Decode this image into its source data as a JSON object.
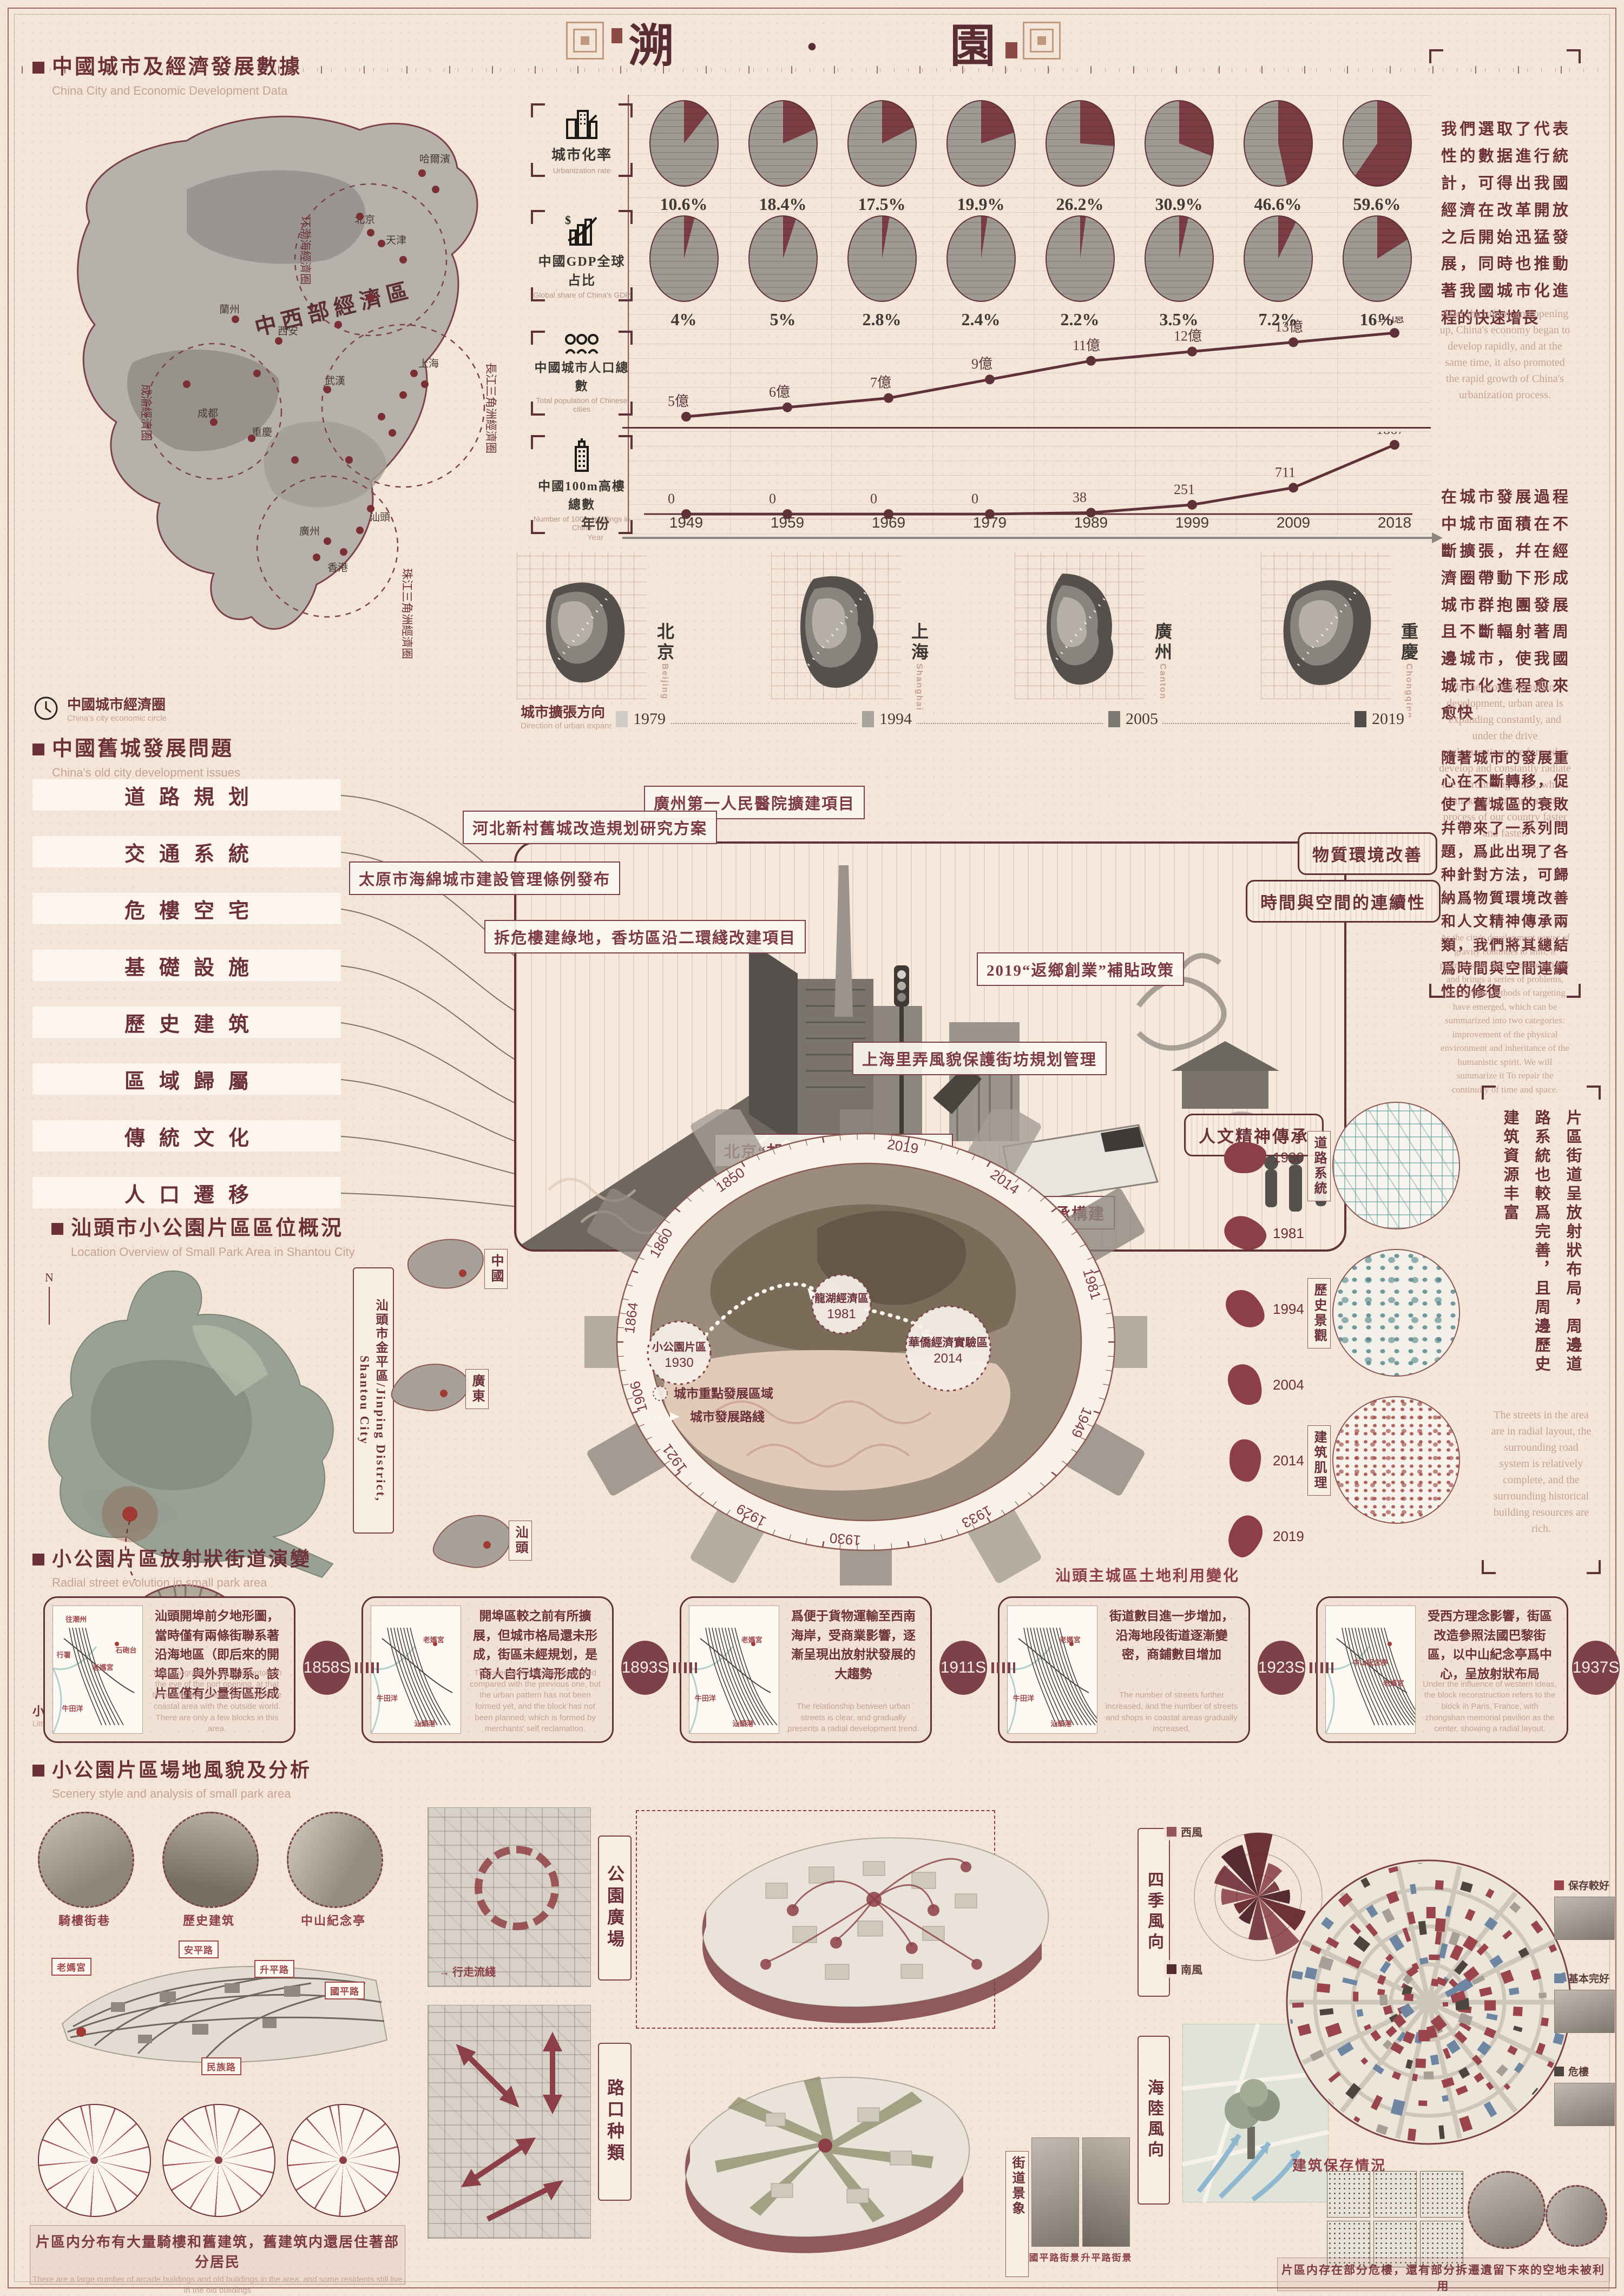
{
  "title": "溯 · 園",
  "sec1": {
    "heading_zh": "中國城市及經濟發展數據",
    "heading_en": "China City and Economic Development Data",
    "map": {
      "center": "中西部經濟區",
      "circles": [
        "环渤海經濟圈",
        "長江三角洲經濟圈",
        "珠江三角洲經濟圈",
        "成渝經濟圈"
      ],
      "cities": [
        "哈爾濱",
        "北京",
        "天津",
        "西安",
        "蘭州",
        "成都",
        "重慶",
        "武漢",
        "上海",
        "廣州",
        "汕頭",
        "香港"
      ]
    },
    "rows": [
      {
        "label_zh": "城市化率",
        "label_en": "Urbanization rate",
        "values": [
          "10.6%",
          "18.4%",
          "17.5%",
          "19.9%",
          "26.2%",
          "30.9%",
          "46.6%",
          "59.6%"
        ]
      },
      {
        "label_zh": "中國GDP全球占比",
        "label_en": "Global share of China's GDP",
        "values": [
          "4%",
          "5%",
          "2.8%",
          "2.4%",
          "2.2%",
          "3.5%",
          "7.2%",
          "16%"
        ]
      },
      {
        "label_zh": "中國城市人口總數",
        "label_en": "Total population of Chinese cities",
        "values": [
          "5億",
          "6億",
          "7億",
          "9億",
          "11億",
          "12億",
          "13億",
          "14億"
        ]
      },
      {
        "label_zh": "中國100m高樓總數",
        "label_en": "Number of 100m buildings in China",
        "values": [
          "0",
          "0",
          "0",
          "0",
          "38",
          "251",
          "711",
          "1867"
        ]
      }
    ],
    "year_axis": {
      "label_zh": "年份",
      "label_en": "Year",
      "years": [
        "1949",
        "1959",
        "1969",
        "1979",
        "1989",
        "1999",
        "2009",
        "2018"
      ]
    },
    "panel1": {
      "zh": "我們選取了代表性的數据進行統計，可得出我國經濟在改革開放之后開始迅猛發展，同時也推動著我國城市化進程的快速增長",
      "en": "After the reform and opening up, China's economy began to develop rapidly, and at the same time, it also promoted the rapid growth of China's urbanization process."
    }
  },
  "sec2": {
    "econ_zh": "中國城市經濟圈",
    "econ_en": "China's city economic circle",
    "dir_zh": "城市擴張方向",
    "dir_en": "Direction of urban expansion",
    "cities": [
      {
        "zh": "北京",
        "en": "Beijing"
      },
      {
        "zh": "上海",
        "en": "Shanghai"
      },
      {
        "zh": "廣州",
        "en": "Canton"
      },
      {
        "zh": "重慶",
        "en": "Chongqing"
      }
    ],
    "years": [
      "1979",
      "1994",
      "2005",
      "2019"
    ],
    "panel2": {
      "zh": "在城市發展過程中城市面積在不斷擴張，幷在經濟圈帶動下形成城市群抱團發展且不斷輻射著周邊城市，使我國城市化進程愈來愈快",
      "en": "In the process of urban development, urban area is expanding constantly, and under the drive agglomerations are formed to develop and constantly radiate the surrounding cities, which makes the urbanization process of our country faster and faster."
    }
  },
  "sec3": {
    "heading_zh": "中國舊城發展問題",
    "heading_en": "China's old city development issues",
    "problems": [
      "道路規划",
      "交通系統",
      "危樓空宅",
      "基礎設施",
      "歷史建筑",
      "區域歸屬",
      "傳統文化",
      "人口遷移"
    ],
    "callouts": [
      "廣州第一人民醫院擴建項目",
      "河北新村舊城改造規划研究方案",
      "太原市海綿城市建設管理條例發布",
      "拆危樓建綠地，香坊區沿二環綫改建項目",
      "上海里弄風貌保護街坊規划管理",
      "2019“返鄉創業”補貼政策",
      "北京“胡同泡泡”擴充院落空間",
      "重慶推動歷史文化保護傳承構建"
    ],
    "categories": [
      "物質環境改善",
      "時間與空間的連續性",
      "人文精神傳承"
    ],
    "panel3": {
      "zh": "隨著城市的發展重心在不斷轉移，促使了舊城區的衰敗幷帶來了一系列問題，爲此出現了各种針對方法，可歸納爲物質環境改善和人文精神傳承兩類，我們將其總結爲時間與空間連續性的修復",
      "en": "As the city's development center of gravity continues to shift, it promotes the decline of the old city and brings a series of problems, and various methods of targeting have emerged, which can be summarized into two categories: improvement of the physical environment and inheritance of the humanistic spirit. We will summarize it To repair the continuity of time and space."
    }
  },
  "sec4": {
    "heading_zh": "汕頭市小公園片區區位概況",
    "heading_en": "Location Overview of Small Park Area in Shantou City",
    "compass": "N",
    "district": "汕頭市金平區/Jinping District, Shantou City",
    "little_park_zh": "小公園片區",
    "little_park_en": "Little Park Area",
    "regions": [
      "中國",
      "廣東",
      "汕頭"
    ],
    "ring_years": [
      "2019",
      "2014",
      "1981",
      "1949",
      "1933",
      "1930",
      "1929",
      "1921",
      "1906",
      "1864",
      "1860",
      "1850"
    ],
    "markers": [
      {
        "name": "小公園片區",
        "year": "1930"
      },
      {
        "name": "龍湖經濟區",
        "year": "1981"
      },
      {
        "name": "華僑經濟實驗區",
        "year": "2014"
      }
    ],
    "legend_area": "城市重點發展區域",
    "legend_route": "城市發展路綫",
    "landuse_label": "汕頭主城區土地利用變化",
    "landuse_years": [
      "1930",
      "1981",
      "1994",
      "2004",
      "2014",
      "2019"
    ],
    "textures": [
      "道路系統",
      "歷史景觀",
      "建筑肌理"
    ],
    "panel4": {
      "zh": "片區街道呈放射狀布局，周邊道路系統也較爲完善，且周邊歷史建筑資源丰富",
      "en": "The streets in the area are in radial layout, the surrounding road system is relatively complete, and the surrounding historical building resources are rich."
    }
  },
  "sec5": {
    "heading_zh": "小公園片區放射狀街道演變",
    "heading_en": "Radial street evolution in small park area",
    "badges": [
      "1858S",
      "1893S",
      "1911S",
      "1923S",
      "1937S"
    ],
    "stages": [
      {
        "zh": "汕頭開埠前夕地形圖，當時僅有兩條街聯系著沿海地區（即后來的開埠區）與外界聯系。該片區僅有少量街區形成",
        "en": "The topographic map of Shantou on the eve of the port opening, at that time, only two streets connected the coastal area with the outside world. There are only a few blocks in this area.",
        "labels": [
          "往潮州",
          "行署",
          "老媽宮",
          "石砲台",
          "牛田洋"
        ]
      },
      {
        "zh": "開埠區較之前有所擴展，但城市格局還未形成，街區未經規划，是商人自行填海形成的",
        "en": "The open port area has expanded compared with the previous one, but the urban pattern has not been formed yet, and the block has not been planned, which is formed by merchants' self reclamation.",
        "labels": [
          "老媽宮",
          "牛田洋",
          "汕頭港"
        ]
      },
      {
        "zh": "爲便于貨物運輸至西南海岸，受商業影響，逐漸呈現出放射狀發展的大趨勢",
        "en": "The relationship between urban streets is clear, and gradually presents a radial development trend.",
        "labels": [
          "老媽宮",
          "牛田洋",
          "汕頭港"
        ]
      },
      {
        "zh": "街道數目進一步增加，沿海地段街道逐漸變密，商鋪數目增加",
        "en": "The number of streets further increased, and the number of streets and shops in coastal areas gradually increased.",
        "labels": [
          "老媽宮",
          "牛田洋",
          "汕頭港"
        ]
      },
      {
        "zh": "受西方理念影響，街區改造參照法國巴黎街區，以中山紀念亭爲中心，呈放射狀布局",
        "en": "Under the influence of western ideas, the block reconstruction refers to the block in Paris, France, with zhongshan memorial pavilion as the center, showing a radial layout.",
        "labels": [
          "中山紀念亭",
          "老媽宮"
        ]
      }
    ]
  },
  "sec6": {
    "heading_zh": "小公園片區場地風貌及分析",
    "heading_en": "Scenery style and analysis of small park area",
    "photo_tags": [
      "騎樓街巷",
      "歷史建筑",
      "中山紀念亭"
    ],
    "axon_labels": [
      "老媽宮",
      "安平路",
      "升平路",
      "國平路",
      "民族路"
    ],
    "walk_legend": "行走流綫",
    "left_tags": [
      "公園廣場",
      "路口种類"
    ],
    "wind_tag": "四季風向",
    "sea_tag": "海陸風向",
    "street_tag": "街道景象",
    "wind_legend": [
      "西風",
      "南風"
    ],
    "street_captions": [
      "國平路街景",
      "升平路街景"
    ],
    "preserve_label": "建筑保存情況",
    "preserve_legend": [
      "保存較好",
      "基本完好",
      "危樓"
    ],
    "caption_left": {
      "zh": "片區内分布有大量騎樓和舊建筑，舊建筑内還居住著部分居民",
      "en": "There are a large number of arcade buildings and old buildings in the area, and some residents still live in the old buildings"
    },
    "caption_right": {
      "zh": "片區内存在部分危樓，還有部分拆遷遺留下來的空地未被利用",
      "en": "There are some dangerous buildings in the area, and some vacant land left by demolition has not been used"
    }
  },
  "chart_data": [
    {
      "type": "pie",
      "title": "城市化率 Urbanization rate (%)",
      "categories": [
        "1949",
        "1959",
        "1969",
        "1979",
        "1989",
        "1999",
        "2009",
        "2018"
      ],
      "values": [
        10.6,
        18.4,
        17.5,
        19.9,
        26.2,
        30.9,
        46.6,
        59.6
      ]
    },
    {
      "type": "pie",
      "title": "中國GDP全球占比 Global share of China's GDP (%)",
      "categories": [
        "1949",
        "1959",
        "1969",
        "1979",
        "1989",
        "1999",
        "2009",
        "2018"
      ],
      "values": [
        4,
        5,
        2.8,
        2.4,
        2.2,
        3.5,
        7.2,
        16
      ]
    },
    {
      "type": "line",
      "title": "中國城市人口總數 Total population of Chinese cities (億)",
      "x": [
        1949,
        1959,
        1969,
        1979,
        1989,
        1999,
        2009,
        2018
      ],
      "values": [
        5,
        6,
        7,
        9,
        11,
        12,
        13,
        14
      ],
      "labels": [
        "5億",
        "6億",
        "7億",
        "9億",
        "11億",
        "12億",
        "13億",
        "14億"
      ],
      "ylim": [
        0,
        15
      ]
    },
    {
      "type": "line",
      "title": "中國100m高樓總數 Number of 100m buildings in China",
      "x": [
        1949,
        1959,
        1969,
        1979,
        1989,
        1999,
        2009,
        2018
      ],
      "values": [
        0,
        0,
        0,
        0,
        38,
        251,
        711,
        1867
      ],
      "labels": [
        "0",
        "0",
        "0",
        "0",
        "38",
        "251",
        "711",
        "1867"
      ],
      "ylim": [
        0,
        2000
      ]
    },
    {
      "type": "timeline",
      "title": "城市擴張方向 Direction of urban expansion",
      "years": [
        1979,
        1994,
        2005,
        2019
      ]
    },
    {
      "type": "timeline",
      "title": "汕頭主城區土地利用變化",
      "years": [
        1930,
        1981,
        1994,
        2004,
        2014,
        2019
      ]
    },
    {
      "type": "timeline",
      "title": "小公園片區放射狀街道演變",
      "years": [
        "1858S",
        "1893S",
        "1911S",
        "1923S",
        "1937S"
      ]
    },
    {
      "type": "ring",
      "title": "小公園片區發展時間環",
      "years": [
        1850,
        1860,
        1864,
        1906,
        1921,
        1929,
        1930,
        1933,
        1949,
        1981,
        2014,
        2019
      ]
    }
  ]
}
